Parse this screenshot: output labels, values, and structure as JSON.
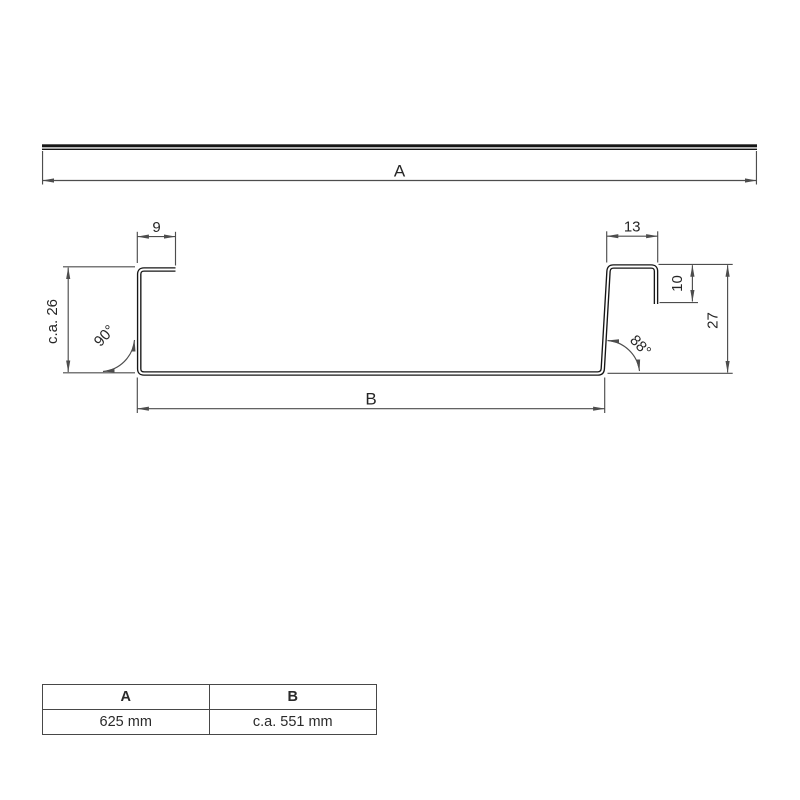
{
  "drawing": {
    "overall_width_label": "A",
    "base_width_label": "B",
    "left_flange_width": "9",
    "right_flange_width": "13",
    "right_lip_height": "10",
    "left_height": "c.a. 26",
    "right_height": "27",
    "left_angle": "90°",
    "right_angle": "88°"
  },
  "table": {
    "headers": [
      "A",
      "B"
    ],
    "values": [
      "625 mm",
      "c.a. 551 mm"
    ]
  },
  "colors": {
    "profile_stroke": "#161616",
    "dimension_stroke": "#4d4d4d",
    "text": "#262626",
    "background": "#ffffff"
  }
}
